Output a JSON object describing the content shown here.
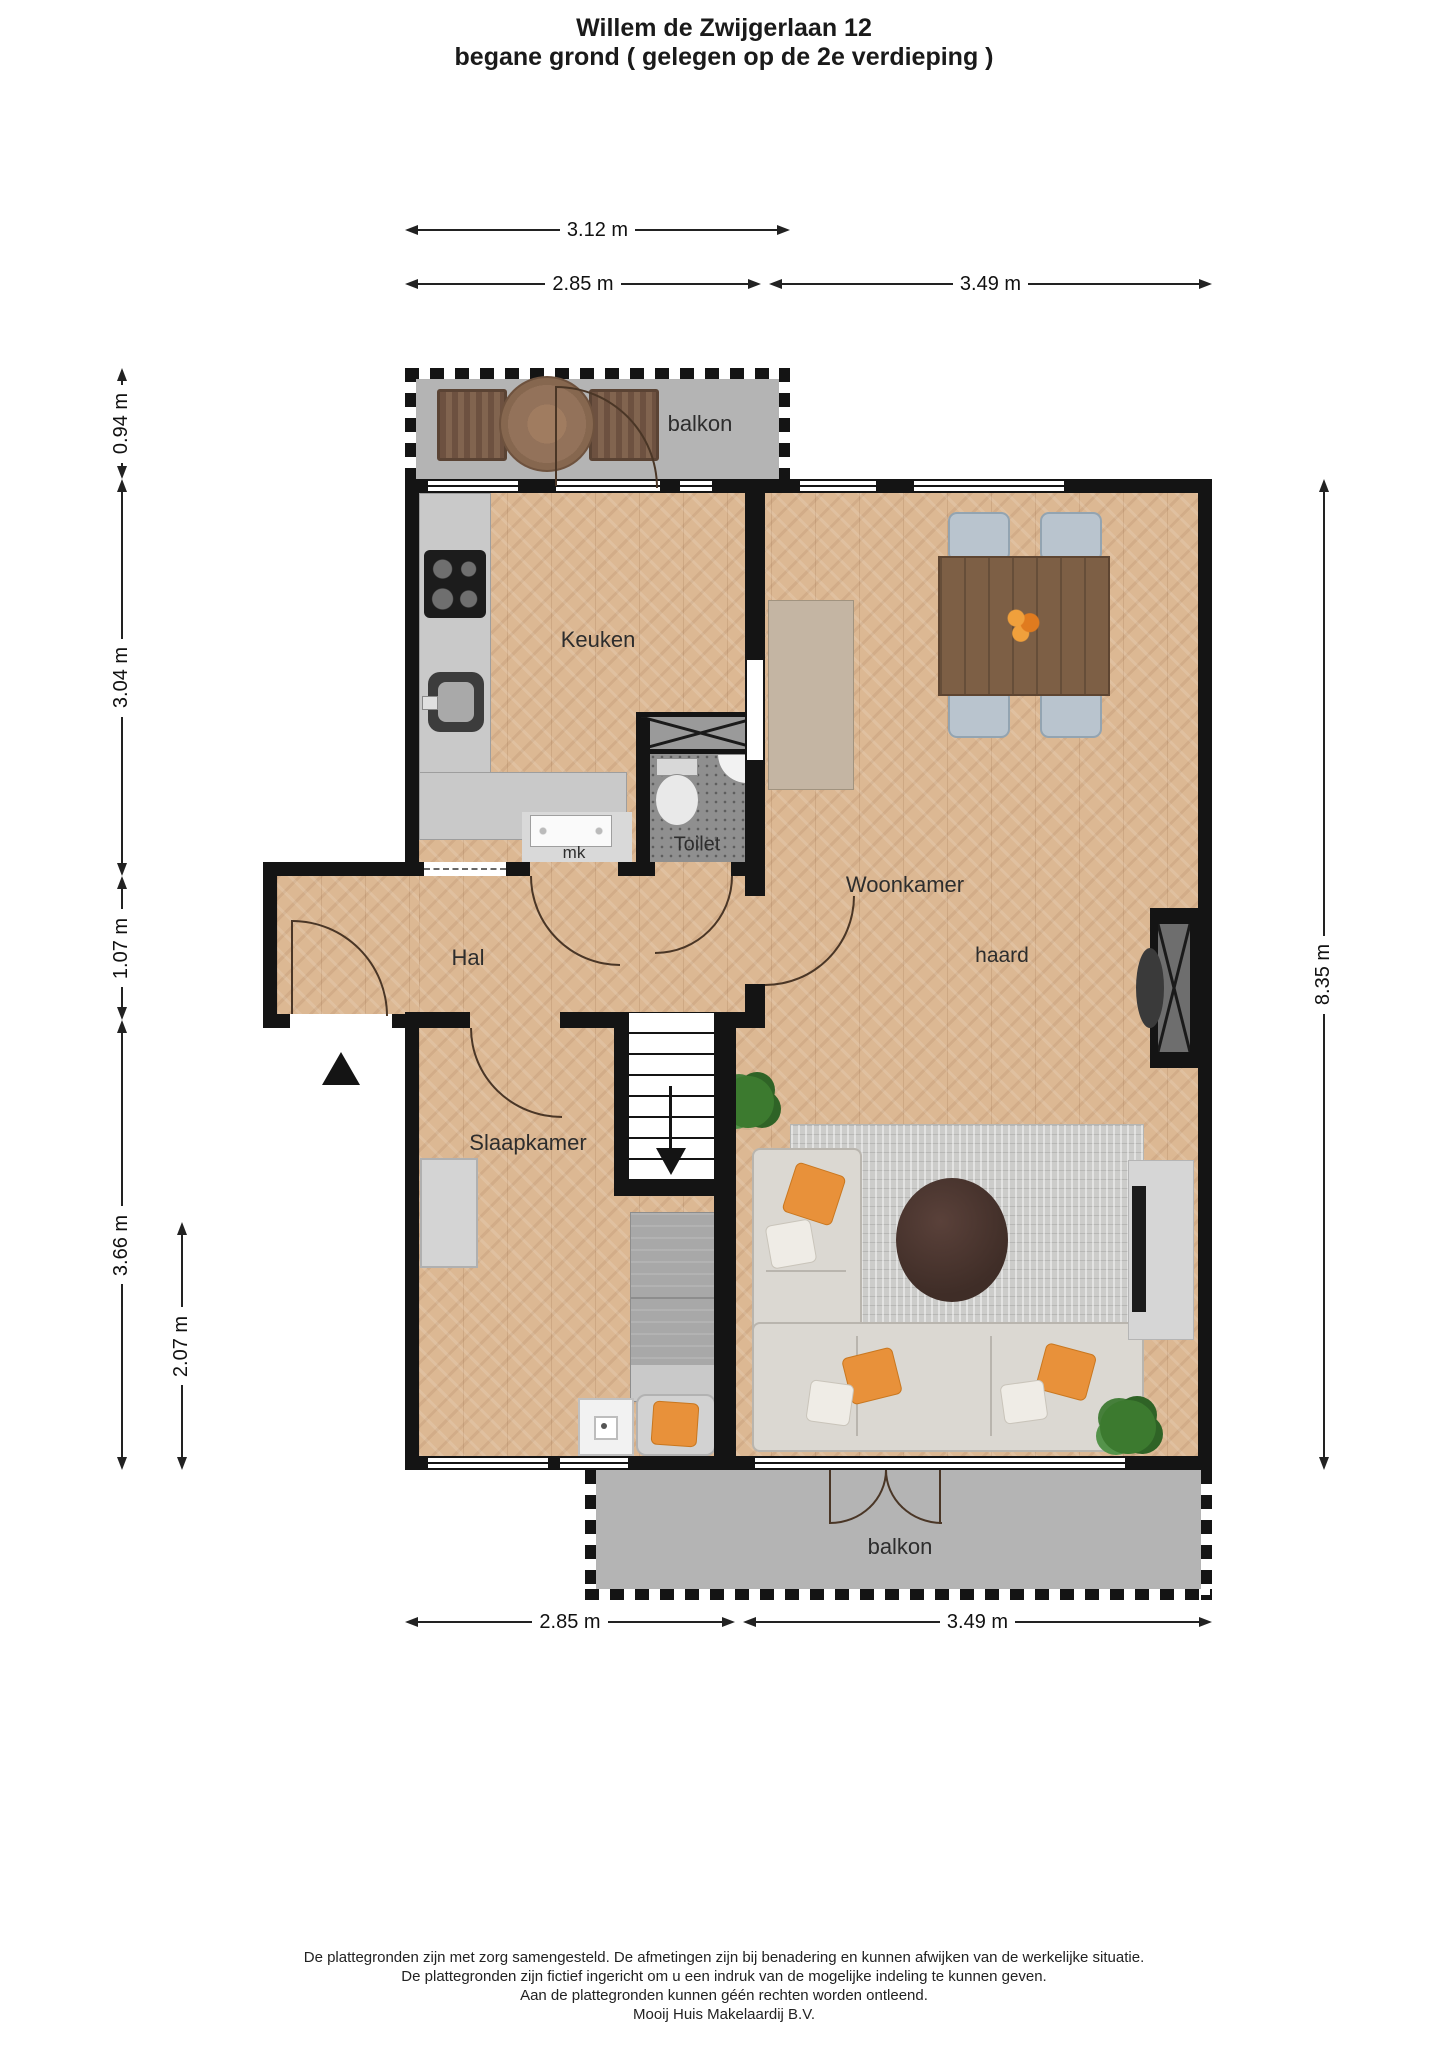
{
  "title": {
    "line1": "Willem de Zwijgerlaan 12",
    "line2": "begane grond ( gelegen op de 2e verdieping )"
  },
  "dimensions": {
    "top_total": "3.12 m",
    "top_left": "2.85 m",
    "top_right": "3.49 m",
    "left_balcony": "0.94 m",
    "left_kitchen": "3.04 m",
    "left_hall": "1.07 m",
    "left_bedroom": "3.66 m",
    "left_bedroom_inner": "2.07 m",
    "right_total": "8.35 m",
    "bottom_left": "2.85 m",
    "bottom_right": "3.49 m"
  },
  "rooms": {
    "balcony_top": "balkon",
    "kitchen": "Keuken",
    "toilet": "Toilet",
    "meter_closet": "mk",
    "hall": "Hal",
    "living_room": "Woonkamer",
    "fireplace": "haard",
    "bedroom": "Slaapkamer",
    "balcony_bottom": "balkon"
  },
  "footer": {
    "line1": "De plattegronden zijn met zorg samengesteld. De afmetingen zijn bij benadering en kunnen afwijken van de werkelijke situatie.",
    "line2": "De plattegronden zijn fictief ingericht om u een indruk van de mogelijke indeling te kunnen geven.",
    "line3": "Aan de plattegronden kunnen géén rechten worden ontleend.",
    "line4": "Mooij Huis Makelaardij B.V."
  },
  "colors": {
    "wall": "#141414",
    "wood_floor": "#dcb893",
    "balcony_floor": "#b4b4b4",
    "accent_orange": "#e8913a"
  }
}
